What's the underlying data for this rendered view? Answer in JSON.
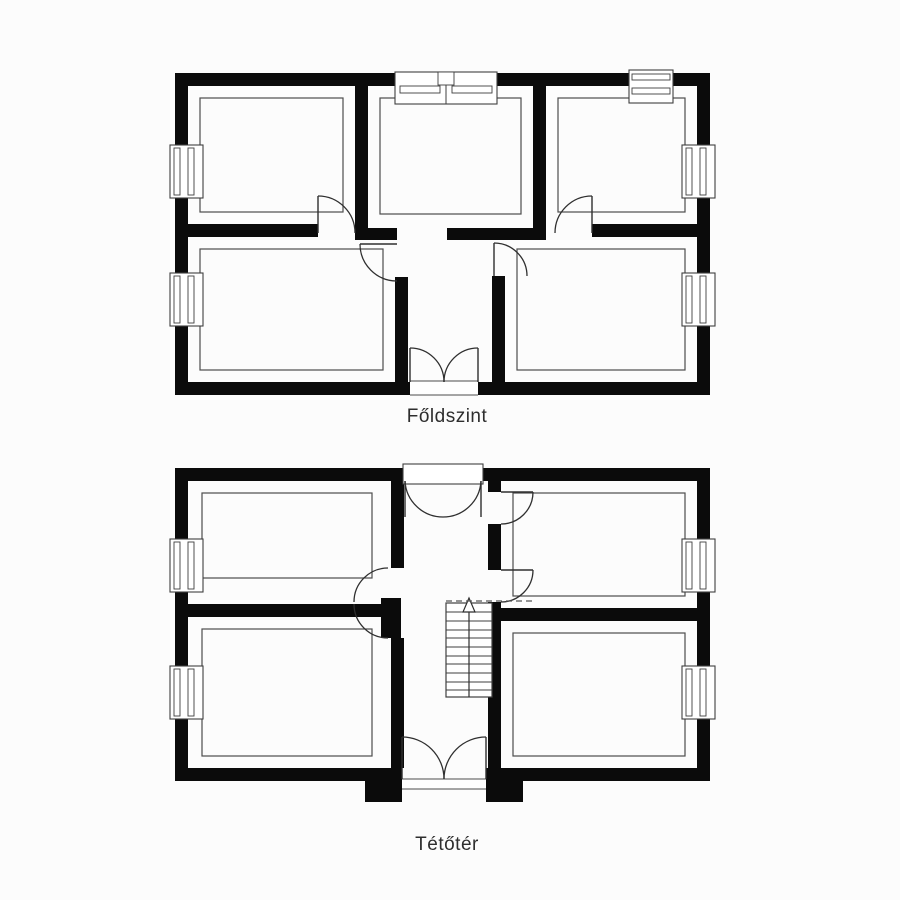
{
  "colors": {
    "background": "#fcfcfc",
    "wall": "#0b0b0b",
    "thin_line": "#4d4d4d",
    "label_text": "#2e2e2e"
  },
  "plans": [
    {
      "name": "ground-floor-plan",
      "label": "Főldszint",
      "label_pos": {
        "x": 447,
        "y": 406
      },
      "walls": [
        [
          175,
          73,
          535,
          13
        ],
        [
          175,
          382,
          235,
          13
        ],
        [
          478,
          382,
          232,
          13
        ],
        [
          175,
          73,
          13,
          322
        ],
        [
          697,
          73,
          13,
          322
        ],
        [
          355,
          86,
          13,
          154
        ],
        [
          533,
          86,
          13,
          154
        ],
        [
          188,
          224,
          130,
          13
        ],
        [
          355,
          228,
          42,
          12
        ],
        [
          447,
          228,
          99,
          12
        ],
        [
          592,
          224,
          105,
          13
        ],
        [
          395,
          277,
          13,
          105
        ],
        [
          492,
          276,
          13,
          106
        ]
      ],
      "outlines": [
        [
          200,
          98,
          143,
          114
        ],
        [
          380,
          98,
          141,
          116
        ],
        [
          558,
          98,
          127,
          114
        ],
        [
          200,
          249,
          183,
          121
        ],
        [
          517,
          249,
          168,
          121
        ]
      ],
      "windows": [
        {
          "rect": [
            170,
            145,
            33,
            53
          ],
          "dir": "v"
        },
        {
          "rect": [
            170,
            273,
            33,
            53
          ],
          "dir": "v"
        },
        {
          "rect": [
            682,
            145,
            33,
            53
          ],
          "dir": "v"
        },
        {
          "rect": [
            682,
            273,
            33,
            53
          ],
          "dir": "v"
        },
        {
          "rect": [
            629,
            70,
            44,
            33
          ],
          "dir": "h"
        }
      ],
      "big_window": {
        "rect": [
          395,
          72,
          102,
          32
        ]
      },
      "sills": [
        [
          410,
          381,
          68,
          14
        ]
      ],
      "door_leaves": [
        [
          318,
          196,
          318,
          233
        ],
        [
          592,
          196,
          592,
          233
        ],
        [
          360,
          244,
          397,
          244
        ],
        [
          494,
          243,
          494,
          276
        ],
        [
          410,
          348,
          410,
          382
        ],
        [
          478,
          348,
          478,
          382
        ]
      ],
      "door_arcs": [
        "M318,196 A37,37 0 0 1 355,233",
        "M555,233 A37,37 0 0 1 592,196",
        "M360,244 A37,37 0 0 0 397,281",
        "M494,243 A33,33 0 0 1 527,276",
        "M410,348 A34,34 0 0 1 444,382",
        "M478,348 A34,34 0 0 0 444,382"
      ]
    },
    {
      "name": "attic-plan",
      "label": "Tétőtér",
      "label_pos": {
        "x": 447,
        "y": 834
      },
      "walls": [
        [
          175,
          468,
          230,
          13
        ],
        [
          481,
          468,
          229,
          13
        ],
        [
          175,
          768,
          227,
          13
        ],
        [
          486,
          768,
          224,
          13
        ],
        [
          175,
          468,
          13,
          313
        ],
        [
          697,
          468,
          13,
          313
        ],
        [
          391,
          481,
          13,
          87
        ],
        [
          188,
          604,
          203,
          13
        ],
        [
          381,
          598,
          20,
          40
        ],
        [
          391,
          638,
          13,
          130
        ],
        [
          488,
          481,
          13,
          11
        ],
        [
          488,
          524,
          13,
          46
        ],
        [
          488,
          602,
          13,
          166
        ],
        [
          488,
          608,
          209,
          13
        ],
        [
          365,
          779,
          37,
          23
        ],
        [
          486,
          779,
          37,
          23
        ]
      ],
      "outlines": [
        [
          202,
          493,
          170,
          85
        ],
        [
          513,
          493,
          172,
          103
        ],
        [
          202,
          629,
          170,
          127
        ],
        [
          513,
          633,
          172,
          123
        ]
      ],
      "windows": [
        {
          "rect": [
            170,
            539,
            33,
            53
          ],
          "dir": "v"
        },
        {
          "rect": [
            170,
            666,
            33,
            53
          ],
          "dir": "v"
        },
        {
          "rect": [
            682,
            539,
            33,
            53
          ],
          "dir": "v"
        },
        {
          "rect": [
            682,
            666,
            33,
            53
          ],
          "dir": "v"
        }
      ],
      "door_boxes": [
        [
          403,
          464,
          80,
          20
        ]
      ],
      "sills": [
        [
          402,
          779,
          84,
          10
        ]
      ],
      "door_leaves": [
        [
          405,
          481,
          405,
          517
        ],
        [
          481,
          481,
          481,
          517
        ],
        [
          501,
          492,
          533,
          492
        ],
        [
          501,
          570,
          533,
          570
        ],
        [
          402,
          737,
          402,
          779
        ],
        [
          486,
          737,
          486,
          779
        ]
      ],
      "door_arcs": [
        "M405,481 A38,38 0 0 0 443,517",
        "M481,481 A38,38 0 0 1 443,517",
        "M533,492 A32,32 0 0 1 501,524",
        "M533,570 A32,32 0 0 1 501,602",
        "M388,568 A34,34 0 0 0 354,602",
        "M388,638 A34,34 0 0 1 354,604",
        "M402,737 A42,42 0 0 1 444,779",
        "M486,737 A42,42 0 0 0 444,779"
      ],
      "stairs": {
        "frame": [
          446,
          603,
          46,
          94
        ],
        "treads_y": [
          612,
          621,
          630,
          638,
          647,
          656,
          664,
          673,
          682,
          690
        ],
        "rail": [
          469,
          606,
          469,
          697
        ],
        "arrow": [
          [
            469,
            598
          ],
          [
            463,
            612
          ],
          [
            475,
            612
          ]
        ]
      },
      "dashed": [
        [
          446,
          601,
          534,
          601
        ]
      ]
    }
  ]
}
